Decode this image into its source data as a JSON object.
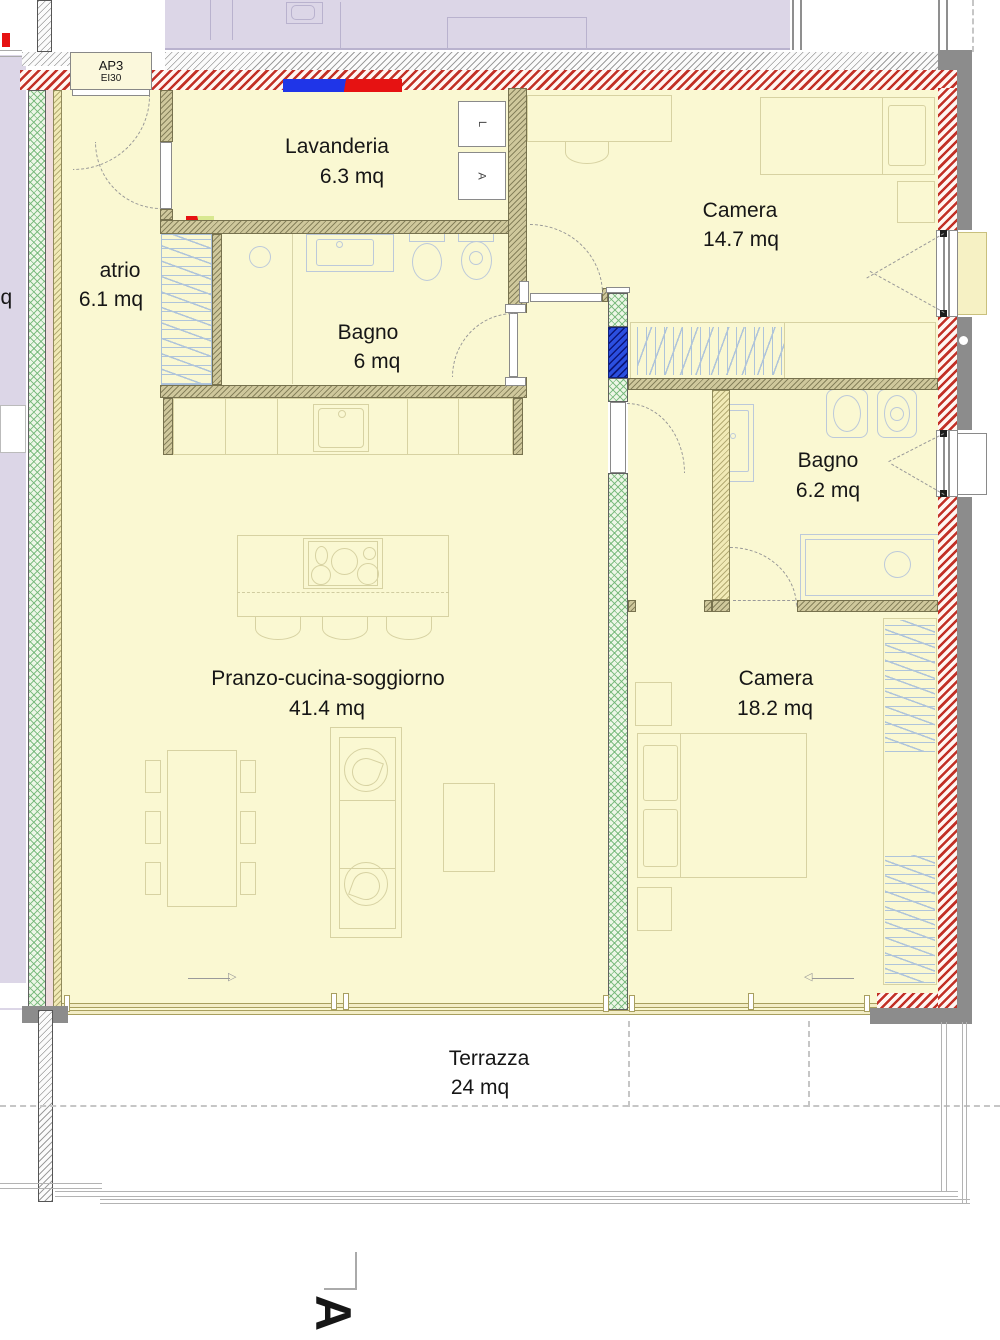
{
  "plan": {
    "entrance": {
      "code": "AP3",
      "fire_rating": "EI30"
    },
    "rooms": [
      {
        "name": "Lavanderia",
        "area": "6.3 mq"
      },
      {
        "name": "Camera",
        "area": "14.7 mq"
      },
      {
        "name": "atrio",
        "area": "6.1 mq"
      },
      {
        "name": "Bagno",
        "area": "6 mq"
      },
      {
        "name": "Bagno",
        "area": "6.2 mq"
      },
      {
        "name": "Pranzo-cucina-soggiorno",
        "area": "41.4 mq"
      },
      {
        "name": "Camera",
        "area": "18.2 mq"
      },
      {
        "name": "Terrazza",
        "area": "24 mq"
      }
    ],
    "appliance_labels": {
      "washing_machine": "L",
      "dryer": "A"
    },
    "adjacent_text_fragment": "mq",
    "section_marker": "A",
    "colors": {
      "room_fill": "#FAF8D2",
      "exterior_wall_red": "#C23026",
      "insulation_green": "#8CC48E",
      "structural_blue": "#2B4FE0",
      "outer_band_gray": "#8C8C8C",
      "neighbor_fill": "#DCD6E7",
      "interior_wall_olive": "#CFC89C"
    }
  }
}
